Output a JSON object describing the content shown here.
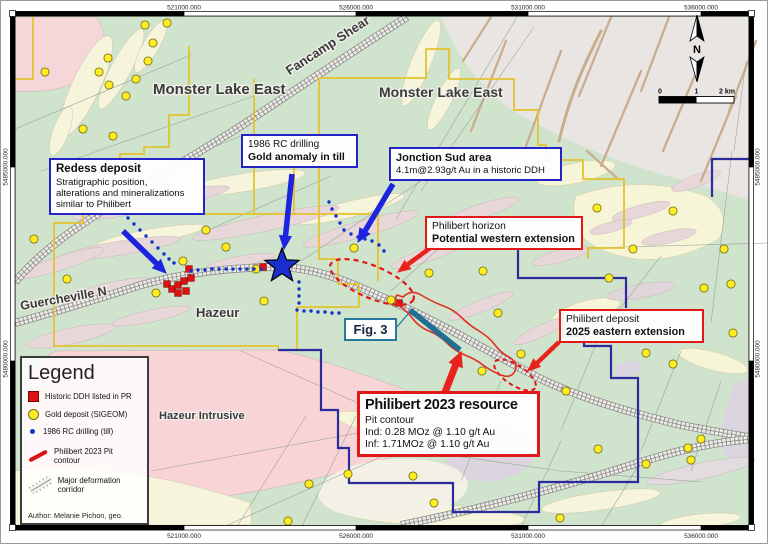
{
  "frame": {
    "top": [
      "521000.000",
      "526000.000",
      "531000.000",
      "536000.000"
    ],
    "side_upper": "5485000.000",
    "side_lower": "5480000.000"
  },
  "compass": {
    "north": "N"
  },
  "scalebar": {
    "zero": "0",
    "one": "1",
    "two": "2 km"
  },
  "map_labels": {
    "monster_west": "Monster Lake East",
    "monster_east": "Monster Lake East",
    "fancamp": "Fancamp Shear",
    "guercheville": "Guercheville N",
    "hazeur": "Hazeur",
    "hazeur_intrusive": "Hazeur Intrusive"
  },
  "callouts": {
    "redess": {
      "title": "Redess deposit",
      "line1": "Stratigraphic position,",
      "line2": "alterations and mineralizations",
      "line3": "similar to Philibert"
    },
    "rc_drilling": {
      "line1": "1986 RC drilling",
      "line2": "Gold anomaly in till"
    },
    "jonction": {
      "line1": "Jonction Sud area",
      "line2": "4.1m@2.93g/t Au in a historic DDH"
    },
    "horizon": {
      "line1": "Philibert horizon",
      "line2": "Potential western extension"
    },
    "deposit": {
      "line1": "Philibert deposit",
      "line2": "2025 eastern extension"
    },
    "fig3": {
      "label": "Fig. 3"
    },
    "resource": {
      "title": "Philibert 2023 resource",
      "line1": "Pit contour",
      "line2": "Ind: 0.28 MOz @ 1.10 g/t Au",
      "line3": "Inf: 1.71MOz @ 1.10 g/t Au"
    }
  },
  "legend": {
    "title": "Legend",
    "items": [
      {
        "symbol": "red-square",
        "label": "Historic DDH listed in PR"
      },
      {
        "symbol": "gold-circle",
        "label": "Gold deposit (SIGEOM)"
      },
      {
        "symbol": "blue-dot",
        "label": "1986 RC drilling (till)"
      },
      {
        "symbol": "red-line",
        "label": "Philibert 2023 Pit contour"
      },
      {
        "symbol": "corridor",
        "label": "Major deformation corridor"
      }
    ],
    "author": "Author: Melanie Pichon, geo."
  },
  "colors": {
    "callout_blue": "#2323c8",
    "callout_red": "#e01818",
    "callout_teal": "#2878a0",
    "arrow_blue": "#1c24e0",
    "arrow_red": "#e8231c",
    "gold": "#ffec22",
    "gold_edge": "#7a731a",
    "ddh_red": "#dd1111",
    "rc_blue": "#1133cc",
    "boundary_yellow": "#e3c32e",
    "boundary_navy": "#2b2b9b",
    "star_blue": "#1b2fd0",
    "pit_red": "#e03020",
    "teal_line": "#1e6f93"
  },
  "markers": {
    "gold_deposits": [
      [
        144,
        24
      ],
      [
        166,
        22
      ],
      [
        152,
        42
      ],
      [
        147,
        60
      ],
      [
        107,
        57
      ],
      [
        98,
        71
      ],
      [
        108,
        84
      ],
      [
        135,
        78
      ],
      [
        125,
        95
      ],
      [
        112,
        135
      ],
      [
        44,
        71
      ],
      [
        82,
        128
      ],
      [
        33,
        238
      ],
      [
        205,
        229
      ],
      [
        225,
        246
      ],
      [
        182,
        260
      ],
      [
        66,
        278
      ],
      [
        155,
        292
      ],
      [
        263,
        300
      ],
      [
        353,
        247
      ],
      [
        390,
        299
      ],
      [
        428,
        272
      ],
      [
        482,
        270
      ],
      [
        497,
        312
      ],
      [
        255,
        268
      ],
      [
        596,
        207
      ],
      [
        672,
        210
      ],
      [
        723,
        248
      ],
      [
        632,
        248
      ],
      [
        730,
        283
      ],
      [
        703,
        287
      ],
      [
        608,
        277
      ],
      [
        732,
        332
      ],
      [
        645,
        352
      ],
      [
        672,
        363
      ],
      [
        565,
        390
      ],
      [
        520,
        353
      ],
      [
        481,
        370
      ],
      [
        347,
        473
      ],
      [
        412,
        475
      ],
      [
        433,
        502
      ],
      [
        559,
        517
      ],
      [
        308,
        483
      ],
      [
        287,
        520
      ],
      [
        597,
        448
      ],
      [
        645,
        463
      ],
      [
        687,
        447
      ],
      [
        700,
        438
      ],
      [
        690,
        459
      ]
    ],
    "historic_ddh": [
      [
        166,
        283
      ],
      [
        171,
        288
      ],
      [
        177,
        284
      ],
      [
        183,
        280
      ],
      [
        177,
        292
      ],
      [
        185,
        290
      ],
      [
        190,
        277
      ],
      [
        188,
        268
      ],
      [
        262,
        266
      ],
      [
        398,
        302
      ]
    ],
    "rc_till_dots": [
      [
        127,
        217
      ],
      [
        133,
        223
      ],
      [
        139,
        229
      ],
      [
        145,
        235
      ],
      [
        151,
        241
      ],
      [
        157,
        247
      ],
      [
        163,
        253
      ],
      [
        168,
        258
      ],
      [
        173,
        262
      ],
      [
        190,
        270
      ],
      [
        197,
        269
      ],
      [
        204,
        269
      ],
      [
        211,
        268
      ],
      [
        218,
        268
      ],
      [
        225,
        268
      ],
      [
        232,
        268
      ],
      [
        239,
        268
      ],
      [
        246,
        268
      ],
      [
        253,
        268
      ],
      [
        260,
        268
      ],
      [
        298,
        281
      ],
      [
        298,
        288
      ],
      [
        298,
        295
      ],
      [
        298,
        302
      ],
      [
        296,
        309
      ],
      [
        303,
        310
      ],
      [
        310,
        310
      ],
      [
        317,
        311
      ],
      [
        324,
        311
      ],
      [
        331,
        312
      ],
      [
        338,
        312
      ],
      [
        328,
        201
      ],
      [
        331,
        208
      ],
      [
        335,
        215
      ],
      [
        339,
        222
      ],
      [
        343,
        229
      ],
      [
        350,
        233
      ],
      [
        357,
        236
      ],
      [
        364,
        238
      ],
      [
        371,
        240
      ],
      [
        378,
        244
      ],
      [
        383,
        250
      ],
      [
        437,
        247
      ],
      [
        444,
        244
      ],
      [
        451,
        242
      ],
      [
        458,
        240
      ]
    ]
  }
}
